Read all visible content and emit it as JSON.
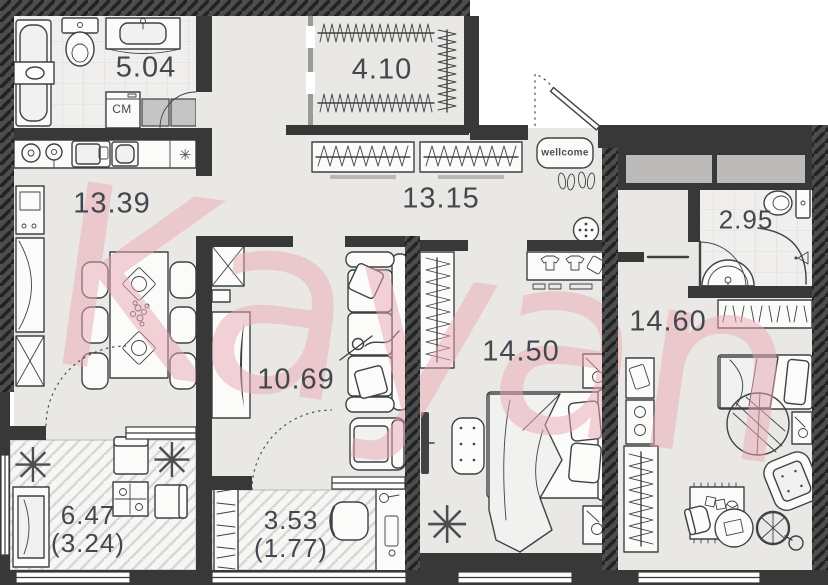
{
  "watermark": {
    "text": "Kayan",
    "color": "#eba9b4"
  },
  "rooms": [
    {
      "name": "bathroom-main",
      "area": "5.04"
    },
    {
      "name": "dressing-room",
      "area": "4.10"
    },
    {
      "name": "hallway",
      "area": "13.15"
    },
    {
      "name": "kitchen-living",
      "area": "13.39"
    },
    {
      "name": "wc-small",
      "area": "2.95"
    },
    {
      "name": "bedroom",
      "area": "14.50"
    },
    {
      "name": "kids-room",
      "area": "14.60"
    },
    {
      "name": "living-room",
      "area": "10.69"
    },
    {
      "name": "balcony-left",
      "area": "6.47",
      "area_secondary": "(3.24)"
    },
    {
      "name": "balcony-center",
      "area": "3.53",
      "area_secondary": "(1.77)"
    }
  ],
  "labels": {
    "washing_machine": "СМ",
    "doormat": "wellcome"
  },
  "icons": {
    "star": "✳"
  },
  "colors": {
    "wall": "#383838",
    "floor": "#e9e8e5",
    "tile_floor": "#f0efed",
    "balcony_floor": "#f6f6f4",
    "cabinet_gray": "#c6c5c3",
    "watermark_pink": "#eba9b4",
    "line": "#3f4145"
  }
}
